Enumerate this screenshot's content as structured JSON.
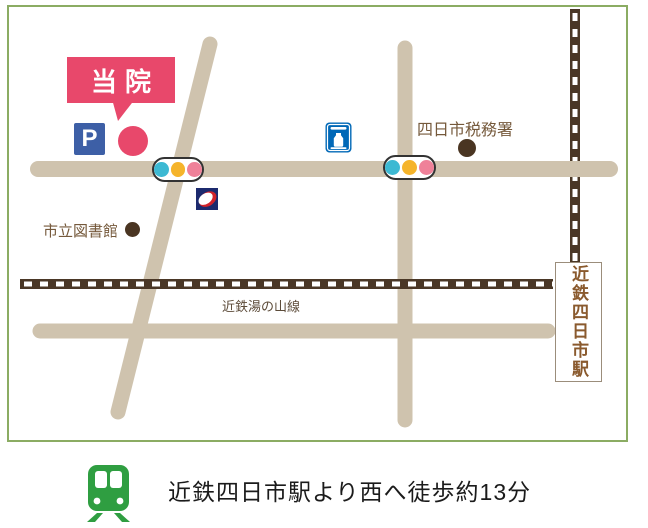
{
  "map": {
    "clinic": {
      "label": "当院"
    },
    "parking": {
      "label": "P"
    },
    "landmarks": {
      "library": {
        "label": "市立図書館"
      },
      "tax_office": {
        "label": "四日市税務署"
      }
    },
    "railways": {
      "yunoyama_line": {
        "label": "近鉄湯の山線"
      },
      "station": {
        "label": "近鉄四日市駅"
      }
    },
    "icons": {
      "parking": "parking-icon",
      "lawson": "lawson-station-icon",
      "store": "convenience-store-icon",
      "signal": "traffic-signal-icon",
      "train": "train-icon",
      "clinic_marker": "clinic-location-marker",
      "landmark_marker": "landmark-dot-marker"
    },
    "colors": {
      "frame_green": "#8BAC63",
      "road_tan": "#CFC3AE",
      "railway_brown": "#4A3726",
      "clinic_red": "#E8486B",
      "parking_blue": "#3D5FA6",
      "lawson_blue": "#0068B7",
      "store_navy": "#1C2A6E",
      "store_red": "#D2222A",
      "signal_cyan": "#3DB9D3",
      "signal_yellow": "#F5B42B",
      "signal_pink": "#EF8199",
      "marker_brown": "#4A3522",
      "label_brown": "#75593B",
      "station_text_brown": "#8A5A2E",
      "train_green": "#2F9E41",
      "caption_black": "#1B1B1B"
    }
  },
  "caption": {
    "text": "近鉄四日市駅より西へ徒歩約13分"
  }
}
